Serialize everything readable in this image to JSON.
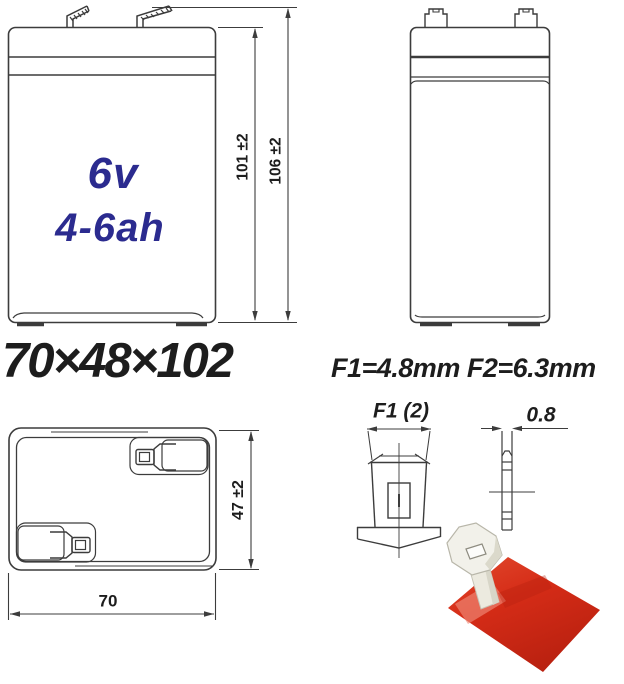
{
  "diagram": {
    "battery": {
      "voltage": "6v",
      "capacity": "4-6ah"
    },
    "size_label": "70×48×102",
    "terminal_spec": "F1=4.8mm F2=6.3mm",
    "dimensions": {
      "case_height": "101 ±2",
      "overall_height": "106 ±2",
      "depth": "47 ±2",
      "width": "70",
      "terminal_width_label": "F1 (2)",
      "terminal_thickness": "0.8"
    }
  },
  "colors": {
    "line": "#3c3c3c",
    "blue_text": "#2b2b8f",
    "red_connector": "#d52c17"
  }
}
